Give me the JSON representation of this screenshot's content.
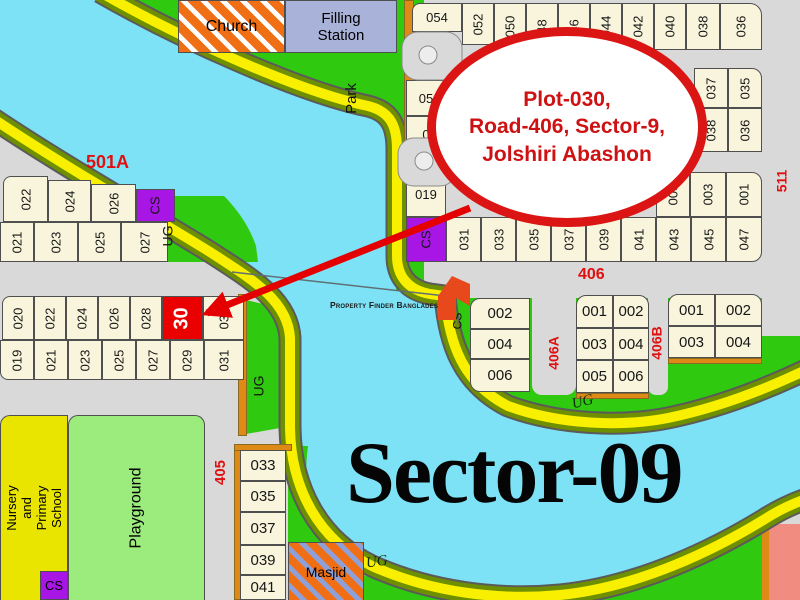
{
  "callout": {
    "line1": "Plot-030,",
    "line2": "Road-406, Sector-9,",
    "line3": "Jolshiri Abashon"
  },
  "sector_label": "Sector-09",
  "watermark": "Property Finder Bangladesh",
  "highlight_plot": "30",
  "roads": {
    "r501a": "501A",
    "r406": "406",
    "r405": "405",
    "r406a": "406A",
    "r406b": "406B",
    "r511": "511"
  },
  "areas": {
    "church": "Church",
    "filling_station": "Filling\nStation",
    "park": "Park",
    "masjid": "Masjid",
    "playground": "Playground",
    "nursery": "Nursery\nand Primary\nSchool",
    "ug1": "UG",
    "ug2": "UG",
    "ug3": "UG",
    "ug4": "UG",
    "cs_green": "CS",
    "cs_nursery": "CS"
  },
  "colors": {
    "river": "#7EE2F6",
    "road_yellow": "#F8F000",
    "road_olive": "#6E8F00",
    "land_gray": "#D9D9D9",
    "green": "#2FC90F",
    "plot_cream": "#F8F5DC",
    "cs_purple": "#A816E6",
    "highlight_red": "#EA0000",
    "label_red": "#E01010",
    "callout_red": "#DB1414",
    "strip_orange": "#DE8A16",
    "salmon": "#F18C80"
  },
  "cells": {
    "row_top": [
      {
        "label": "054",
        "x": 412,
        "y": 3,
        "w": 50,
        "h": 29,
        "r": "8px 0 0 0"
      },
      {
        "label": "052",
        "x": 462,
        "y": 3,
        "w": 32,
        "h": 42,
        "rot": 1
      },
      {
        "label": "050",
        "x": 494,
        "y": 3,
        "w": 32,
        "h": 47,
        "rot": 1
      },
      {
        "label": "48",
        "x": 526,
        "y": 3,
        "w": 32,
        "h": 47,
        "rot": 1
      },
      {
        "label": "46",
        "x": 558,
        "y": 3,
        "w": 32,
        "h": 47,
        "rot": 1
      },
      {
        "label": "044",
        "x": 590,
        "y": 3,
        "w": 32,
        "h": 47,
        "rot": 1
      },
      {
        "label": "042",
        "x": 622,
        "y": 3,
        "w": 32,
        "h": 47,
        "rot": 1
      },
      {
        "label": "040",
        "x": 654,
        "y": 3,
        "w": 32,
        "h": 47,
        "rot": 1
      },
      {
        "label": "038",
        "x": 686,
        "y": 3,
        "w": 34,
        "h": 47,
        "rot": 1
      },
      {
        "label": "036",
        "x": 720,
        "y": 3,
        "w": 42,
        "h": 47,
        "rot": 1,
        "r": "0 12px 0 0"
      }
    ],
    "mid_block": [
      {
        "label": "05",
        "x": 406,
        "y": 80,
        "w": 40,
        "h": 36
      },
      {
        "label": "0",
        "x": 406,
        "y": 116,
        "w": 40,
        "h": 36
      },
      {
        "label": "037",
        "x": 694,
        "y": 68,
        "w": 34,
        "h": 40,
        "rot": 1
      },
      {
        "label": "035",
        "x": 728,
        "y": 68,
        "w": 34,
        "h": 40,
        "rot": 1,
        "r": "0 10px 0 0"
      },
      {
        "label": "038",
        "x": 694,
        "y": 108,
        "w": 34,
        "h": 44,
        "rot": 1
      },
      {
        "label": "036",
        "x": 728,
        "y": 108,
        "w": 34,
        "h": 44,
        "rot": 1
      }
    ],
    "row_c_top": [
      {
        "label": "019",
        "x": 406,
        "y": 172,
        "w": 40,
        "h": 45
      },
      {
        "label": "005",
        "x": 656,
        "y": 172,
        "w": 34,
        "h": 45,
        "rot": 1
      },
      {
        "label": "003",
        "x": 690,
        "y": 172,
        "w": 36,
        "h": 45,
        "rot": 1
      },
      {
        "label": "001",
        "x": 726,
        "y": 172,
        "w": 36,
        "h": 45,
        "rot": 1,
        "r": "0 10px 0 0"
      }
    ],
    "row_c_bottom": [
      {
        "label": "CS",
        "x": 406,
        "y": 217,
        "w": 40,
        "h": 45,
        "rot": 1,
        "fill": "#A816E6"
      },
      {
        "label": "031",
        "x": 446,
        "y": 217,
        "w": 35,
        "h": 45,
        "rot": 1
      },
      {
        "label": "033",
        "x": 481,
        "y": 217,
        "w": 35,
        "h": 45,
        "rot": 1
      },
      {
        "label": "035",
        "x": 516,
        "y": 217,
        "w": 35,
        "h": 45,
        "rot": 1
      },
      {
        "label": "037",
        "x": 551,
        "y": 217,
        "w": 35,
        "h": 45,
        "rot": 1
      },
      {
        "label": "039",
        "x": 586,
        "y": 217,
        "w": 35,
        "h": 45,
        "rot": 1
      },
      {
        "label": "041",
        "x": 621,
        "y": 217,
        "w": 35,
        "h": 45,
        "rot": 1
      },
      {
        "label": "043",
        "x": 656,
        "y": 217,
        "w": 35,
        "h": 45,
        "rot": 1
      },
      {
        "label": "045",
        "x": 691,
        "y": 217,
        "w": 35,
        "h": 45,
        "rot": 1
      },
      {
        "label": "047",
        "x": 726,
        "y": 217,
        "w": 36,
        "h": 45,
        "rot": 1,
        "r": "0 0 10px 0"
      }
    ],
    "block_a_r1": [
      {
        "label": "022",
        "x": 3,
        "y": 176,
        "w": 45,
        "h": 46,
        "rot": 1,
        "r": "8px 0 0 0"
      },
      {
        "label": "024",
        "x": 48,
        "y": 180,
        "w": 43,
        "h": 42,
        "rot": 1
      },
      {
        "label": "026",
        "x": 91,
        "y": 184,
        "w": 45,
        "h": 38,
        "rot": 1
      },
      {
        "label": "CS",
        "x": 136,
        "y": 189,
        "w": 39,
        "h": 33,
        "rot": 1,
        "fill": "#A816E6"
      }
    ],
    "block_a_r2": [
      {
        "label": "021",
        "x": 0,
        "y": 222,
        "w": 34,
        "h": 40,
        "rot": 1
      },
      {
        "label": "023",
        "x": 34,
        "y": 222,
        "w": 44,
        "h": 40,
        "rot": 1
      },
      {
        "label": "025",
        "x": 78,
        "y": 222,
        "w": 43,
        "h": 40,
        "rot": 1
      },
      {
        "label": "027",
        "x": 121,
        "y": 222,
        "w": 47,
        "h": 40,
        "rot": 1
      }
    ],
    "block_b_r1": [
      {
        "label": "020",
        "x": 2,
        "y": 296,
        "w": 32,
        "h": 44,
        "rot": 1,
        "r": "8px 0 0 0"
      },
      {
        "label": "022",
        "x": 34,
        "y": 296,
        "w": 32,
        "h": 44,
        "rot": 1
      },
      {
        "label": "024",
        "x": 66,
        "y": 296,
        "w": 32,
        "h": 44,
        "rot": 1
      },
      {
        "label": "026",
        "x": 98,
        "y": 296,
        "w": 32,
        "h": 44,
        "rot": 1
      },
      {
        "label": "028",
        "x": 130,
        "y": 296,
        "w": 32,
        "h": 44,
        "rot": 1
      },
      {
        "label": "30",
        "x": 162,
        "y": 296,
        "w": 41,
        "h": 44,
        "rot": 1,
        "fill": "#EA0000",
        "color": "#ffffff",
        "fs": 20,
        "bold": 1
      },
      {
        "label": "032",
        "x": 203,
        "y": 296,
        "w": 41,
        "h": 44,
        "rot": 1
      }
    ],
    "block_b_r2": [
      {
        "label": "019",
        "x": 0,
        "y": 340,
        "w": 34,
        "h": 40,
        "rot": 1,
        "r": "0 0 0 8px"
      },
      {
        "label": "021",
        "x": 34,
        "y": 340,
        "w": 34,
        "h": 40,
        "rot": 1
      },
      {
        "label": "023",
        "x": 68,
        "y": 340,
        "w": 34,
        "h": 40,
        "rot": 1
      },
      {
        "label": "025",
        "x": 102,
        "y": 340,
        "w": 34,
        "h": 40,
        "rot": 1
      },
      {
        "label": "027",
        "x": 136,
        "y": 340,
        "w": 34,
        "h": 40,
        "rot": 1
      },
      {
        "label": "029",
        "x": 170,
        "y": 340,
        "w": 34,
        "h": 40,
        "rot": 1
      },
      {
        "label": "031",
        "x": 204,
        "y": 340,
        "w": 40,
        "h": 40,
        "rot": 1
      }
    ],
    "col_405": [
      {
        "label": "033",
        "x": 240,
        "y": 450,
        "w": 46,
        "h": 31,
        "fs": 15
      },
      {
        "label": "035",
        "x": 240,
        "y": 481,
        "w": 46,
        "h": 31,
        "fs": 15
      },
      {
        "label": "037",
        "x": 240,
        "y": 512,
        "w": 46,
        "h": 33,
        "fs": 15
      },
      {
        "label": "039",
        "x": 240,
        "y": 545,
        "w": 46,
        "h": 30,
        "fs": 15
      },
      {
        "label": "041",
        "x": 240,
        "y": 575,
        "w": 46,
        "h": 25,
        "fs": 15
      }
    ],
    "block_d": [
      {
        "label": "002",
        "x": 470,
        "y": 298,
        "w": 60,
        "h": 31,
        "fs": 15,
        "r": "10px 0 0 0"
      },
      {
        "label": "004",
        "x": 470,
        "y": 329,
        "w": 60,
        "h": 30,
        "fs": 15
      },
      {
        "label": "006",
        "x": 470,
        "y": 359,
        "w": 60,
        "h": 33,
        "fs": 15,
        "r": "0 0 0 10px"
      }
    ],
    "block_e": [
      {
        "label": "001",
        "x": 576,
        "y": 295,
        "w": 37,
        "h": 33,
        "fs": 15,
        "r": "10px 0 0 0"
      },
      {
        "label": "002",
        "x": 613,
        "y": 295,
        "w": 36,
        "h": 33,
        "fs": 15,
        "r": "0 10px 0 0"
      },
      {
        "label": "003",
        "x": 576,
        "y": 328,
        "w": 37,
        "h": 32,
        "fs": 15
      },
      {
        "label": "004",
        "x": 613,
        "y": 328,
        "w": 36,
        "h": 32,
        "fs": 15
      },
      {
        "label": "005",
        "x": 576,
        "y": 360,
        "w": 37,
        "h": 33,
        "fs": 15
      },
      {
        "label": "006",
        "x": 613,
        "y": 360,
        "w": 36,
        "h": 33,
        "fs": 15
      }
    ],
    "block_f": [
      {
        "label": "001",
        "x": 668,
        "y": 294,
        "w": 47,
        "h": 32,
        "fs": 15,
        "r": "10px 0 0 0"
      },
      {
        "label": "002",
        "x": 715,
        "y": 294,
        "w": 47,
        "h": 32,
        "fs": 15,
        "r": "0 10px 0 0"
      },
      {
        "label": "003",
        "x": 668,
        "y": 326,
        "w": 47,
        "h": 32,
        "fs": 15
      },
      {
        "label": "004",
        "x": 715,
        "y": 326,
        "w": 47,
        "h": 32,
        "fs": 15
      }
    ],
    "strips": [
      {
        "label": "",
        "x": 404,
        "y": 0,
        "w": 10,
        "h": 150,
        "fill": "#DE8A16",
        "cls": "strip-cell"
      },
      {
        "label": "",
        "x": 238,
        "y": 294,
        "w": 9,
        "h": 142,
        "fill": "#DE8A16",
        "cls": "strip-cell"
      },
      {
        "label": "",
        "x": 234,
        "y": 444,
        "w": 8,
        "h": 156,
        "fill": "#DE8A16",
        "cls": "strip-cell"
      },
      {
        "label": "",
        "x": 234,
        "y": 444,
        "w": 58,
        "h": 7,
        "fill": "#DE8A16",
        "cls": "strip-cell"
      },
      {
        "label": "",
        "x": 576,
        "y": 393,
        "w": 73,
        "h": 6,
        "fill": "#DE8A16",
        "cls": "strip-cell"
      },
      {
        "label": "",
        "x": 668,
        "y": 358,
        "w": 94,
        "h": 6,
        "fill": "#DE8A16",
        "cls": "strip-cell"
      }
    ],
    "minor_roads": [
      {
        "label": "",
        "x": 532,
        "y": 298,
        "w": 44,
        "h": 97,
        "fill": "#D9D9D9",
        "cls": "noborder",
        "r": "0 0 10px 10px"
      },
      {
        "label": "",
        "x": 648,
        "y": 294,
        "w": 20,
        "h": 101,
        "fill": "#D9D9D9",
        "cls": "noborder",
        "r": "0 0 8px 8px"
      }
    ]
  }
}
